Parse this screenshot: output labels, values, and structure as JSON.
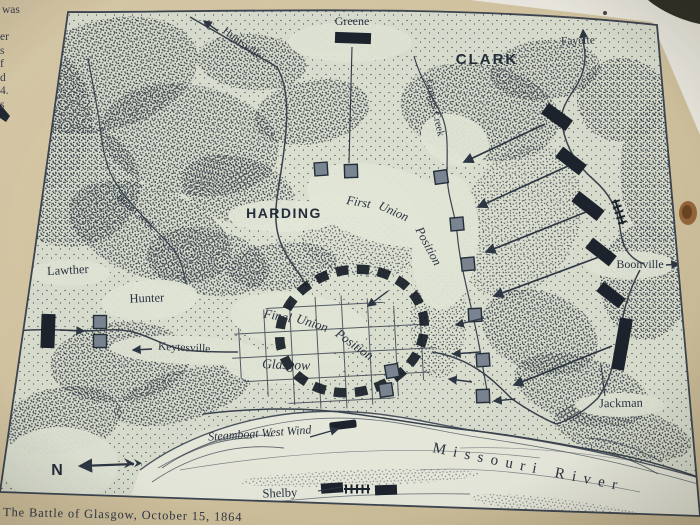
{
  "photo": {
    "caption": "The Battle of Glasgow, October 15, 1864",
    "sign_fragments": [
      "was",
      "er",
      "s",
      "f",
      "d",
      "4.",
      "s"
    ]
  },
  "map": {
    "labels": {
      "greene": "Greene",
      "clark": "CLARK",
      "fayette": "Fayette",
      "huntsville": "Huntsville",
      "greggs_creek": "Greggs Creek",
      "bear_creek": "Bear Creek",
      "harding": "HARDING",
      "first_union_position": {
        "full": "First Union Position",
        "words": [
          "First",
          "Union",
          "Position"
        ]
      },
      "boonville": "Boonville",
      "lawther": "Lawther",
      "hunter": "Hunter",
      "keytesville": "Keytesville",
      "final_union_position": {
        "full": "Final Union Position",
        "words": [
          "Final",
          "Union",
          "Position"
        ]
      },
      "glasgow": "Glasgow",
      "jackman": "Jackman",
      "steamboat": "Steamboat West Wind",
      "missouri_river": "Missouri River",
      "shelby": "Shelby",
      "north": "N"
    },
    "colors": {
      "ink": "#2d3644",
      "paper": "#dce1d2",
      "river": "#eaecdf",
      "sign": "#d8caa8",
      "confederate_unit": "#1c232d",
      "union_unit": "#7b8693",
      "rust_spot": "#96663a"
    },
    "units": {
      "confederate": [
        {
          "x": 353,
          "y": 38,
          "w": 36,
          "h": 11,
          "rot": 2
        },
        {
          "x": 557,
          "y": 117,
          "w": 30,
          "h": 13,
          "rot": 36
        },
        {
          "x": 571,
          "y": 161,
          "w": 30,
          "h": 13,
          "rot": 38
        },
        {
          "x": 588,
          "y": 206,
          "w": 32,
          "h": 13,
          "rot": 38
        },
        {
          "x": 601,
          "y": 252,
          "w": 30,
          "h": 13,
          "rot": 38
        },
        {
          "x": 611,
          "y": 295,
          "w": 28,
          "h": 12,
          "rot": 38
        },
        {
          "x": 622,
          "y": 344,
          "w": 13,
          "h": 52,
          "rot": 10
        },
        {
          "x": 48,
          "y": 331,
          "w": 14,
          "h": 34,
          "rot": 2
        },
        {
          "x": 332,
          "y": 488,
          "w": 22,
          "h": 10,
          "rot": -4
        },
        {
          "x": 386,
          "y": 490,
          "w": 22,
          "h": 10,
          "rot": -2
        }
      ],
      "union": [
        {
          "x": 321,
          "y": 169,
          "rot": -4
        },
        {
          "x": 351,
          "y": 171,
          "rot": -2
        },
        {
          "x": 441,
          "y": 177,
          "rot": -8
        },
        {
          "x": 457,
          "y": 224,
          "rot": -5
        },
        {
          "x": 468,
          "y": 264,
          "rot": -5
        },
        {
          "x": 475,
          "y": 315,
          "rot": -3
        },
        {
          "x": 483,
          "y": 360,
          "rot": -4
        },
        {
          "x": 483,
          "y": 396,
          "rot": -2
        },
        {
          "x": 392,
          "y": 371,
          "rot": -10
        },
        {
          "x": 386,
          "y": 390,
          "rot": -8
        },
        {
          "x": 100,
          "y": 322,
          "rot": 0
        },
        {
          "x": 100,
          "y": 341,
          "rot": 0
        }
      ],
      "steamboat": {
        "x": 343,
        "y": 425,
        "w": 27,
        "h": 8,
        "rot": -7
      }
    },
    "arrows": {
      "attack": [
        {
          "x1": 545,
          "y1": 124,
          "x2": 464,
          "y2": 162
        },
        {
          "x1": 568,
          "y1": 166,
          "x2": 478,
          "y2": 207
        },
        {
          "x1": 586,
          "y1": 212,
          "x2": 486,
          "y2": 252
        },
        {
          "x1": 599,
          "y1": 257,
          "x2": 494,
          "y2": 296
        },
        {
          "x1": 612,
          "y1": 346,
          "x2": 514,
          "y2": 385
        }
      ],
      "small": [
        {
          "x1": 388,
          "y1": 291,
          "x2": 368,
          "y2": 306
        },
        {
          "x1": 484,
          "y1": 318,
          "x2": 456,
          "y2": 325
        },
        {
          "x1": 480,
          "y1": 352,
          "x2": 453,
          "y2": 354
        },
        {
          "x1": 472,
          "y1": 382,
          "x2": 449,
          "y2": 379
        },
        {
          "x1": 515,
          "y1": 399,
          "x2": 494,
          "y2": 401
        }
      ],
      "feature": [
        {
          "x1": 584,
          "y1": 44,
          "x2": 583,
          "y2": 30
        },
        {
          "x1": 666,
          "y1": 265,
          "x2": 679,
          "y2": 264
        },
        {
          "x1": 152,
          "y1": 349,
          "x2": 133,
          "y2": 350
        },
        {
          "x1": 60,
          "y1": 330,
          "x2": 84,
          "y2": 331
        },
        {
          "x1": 218,
          "y1": 31,
          "x2": 204,
          "y2": 21
        },
        {
          "x1": 310,
          "y1": 437,
          "x2": 338,
          "y2": 429
        }
      ],
      "leaders": [
        {
          "x1": 352,
          "y1": 47,
          "x2": 349,
          "y2": 163
        },
        {
          "x1": 318,
          "y1": 491,
          "x2": 342,
          "y2": 487
        },
        {
          "x1": 601,
          "y1": 366,
          "x2": 605,
          "y2": 396
        }
      ]
    },
    "batteries": [
      {
        "x": 357,
        "y": 489,
        "rot": 0
      },
      {
        "x": 619,
        "y": 212,
        "rot": 72
      }
    ]
  }
}
